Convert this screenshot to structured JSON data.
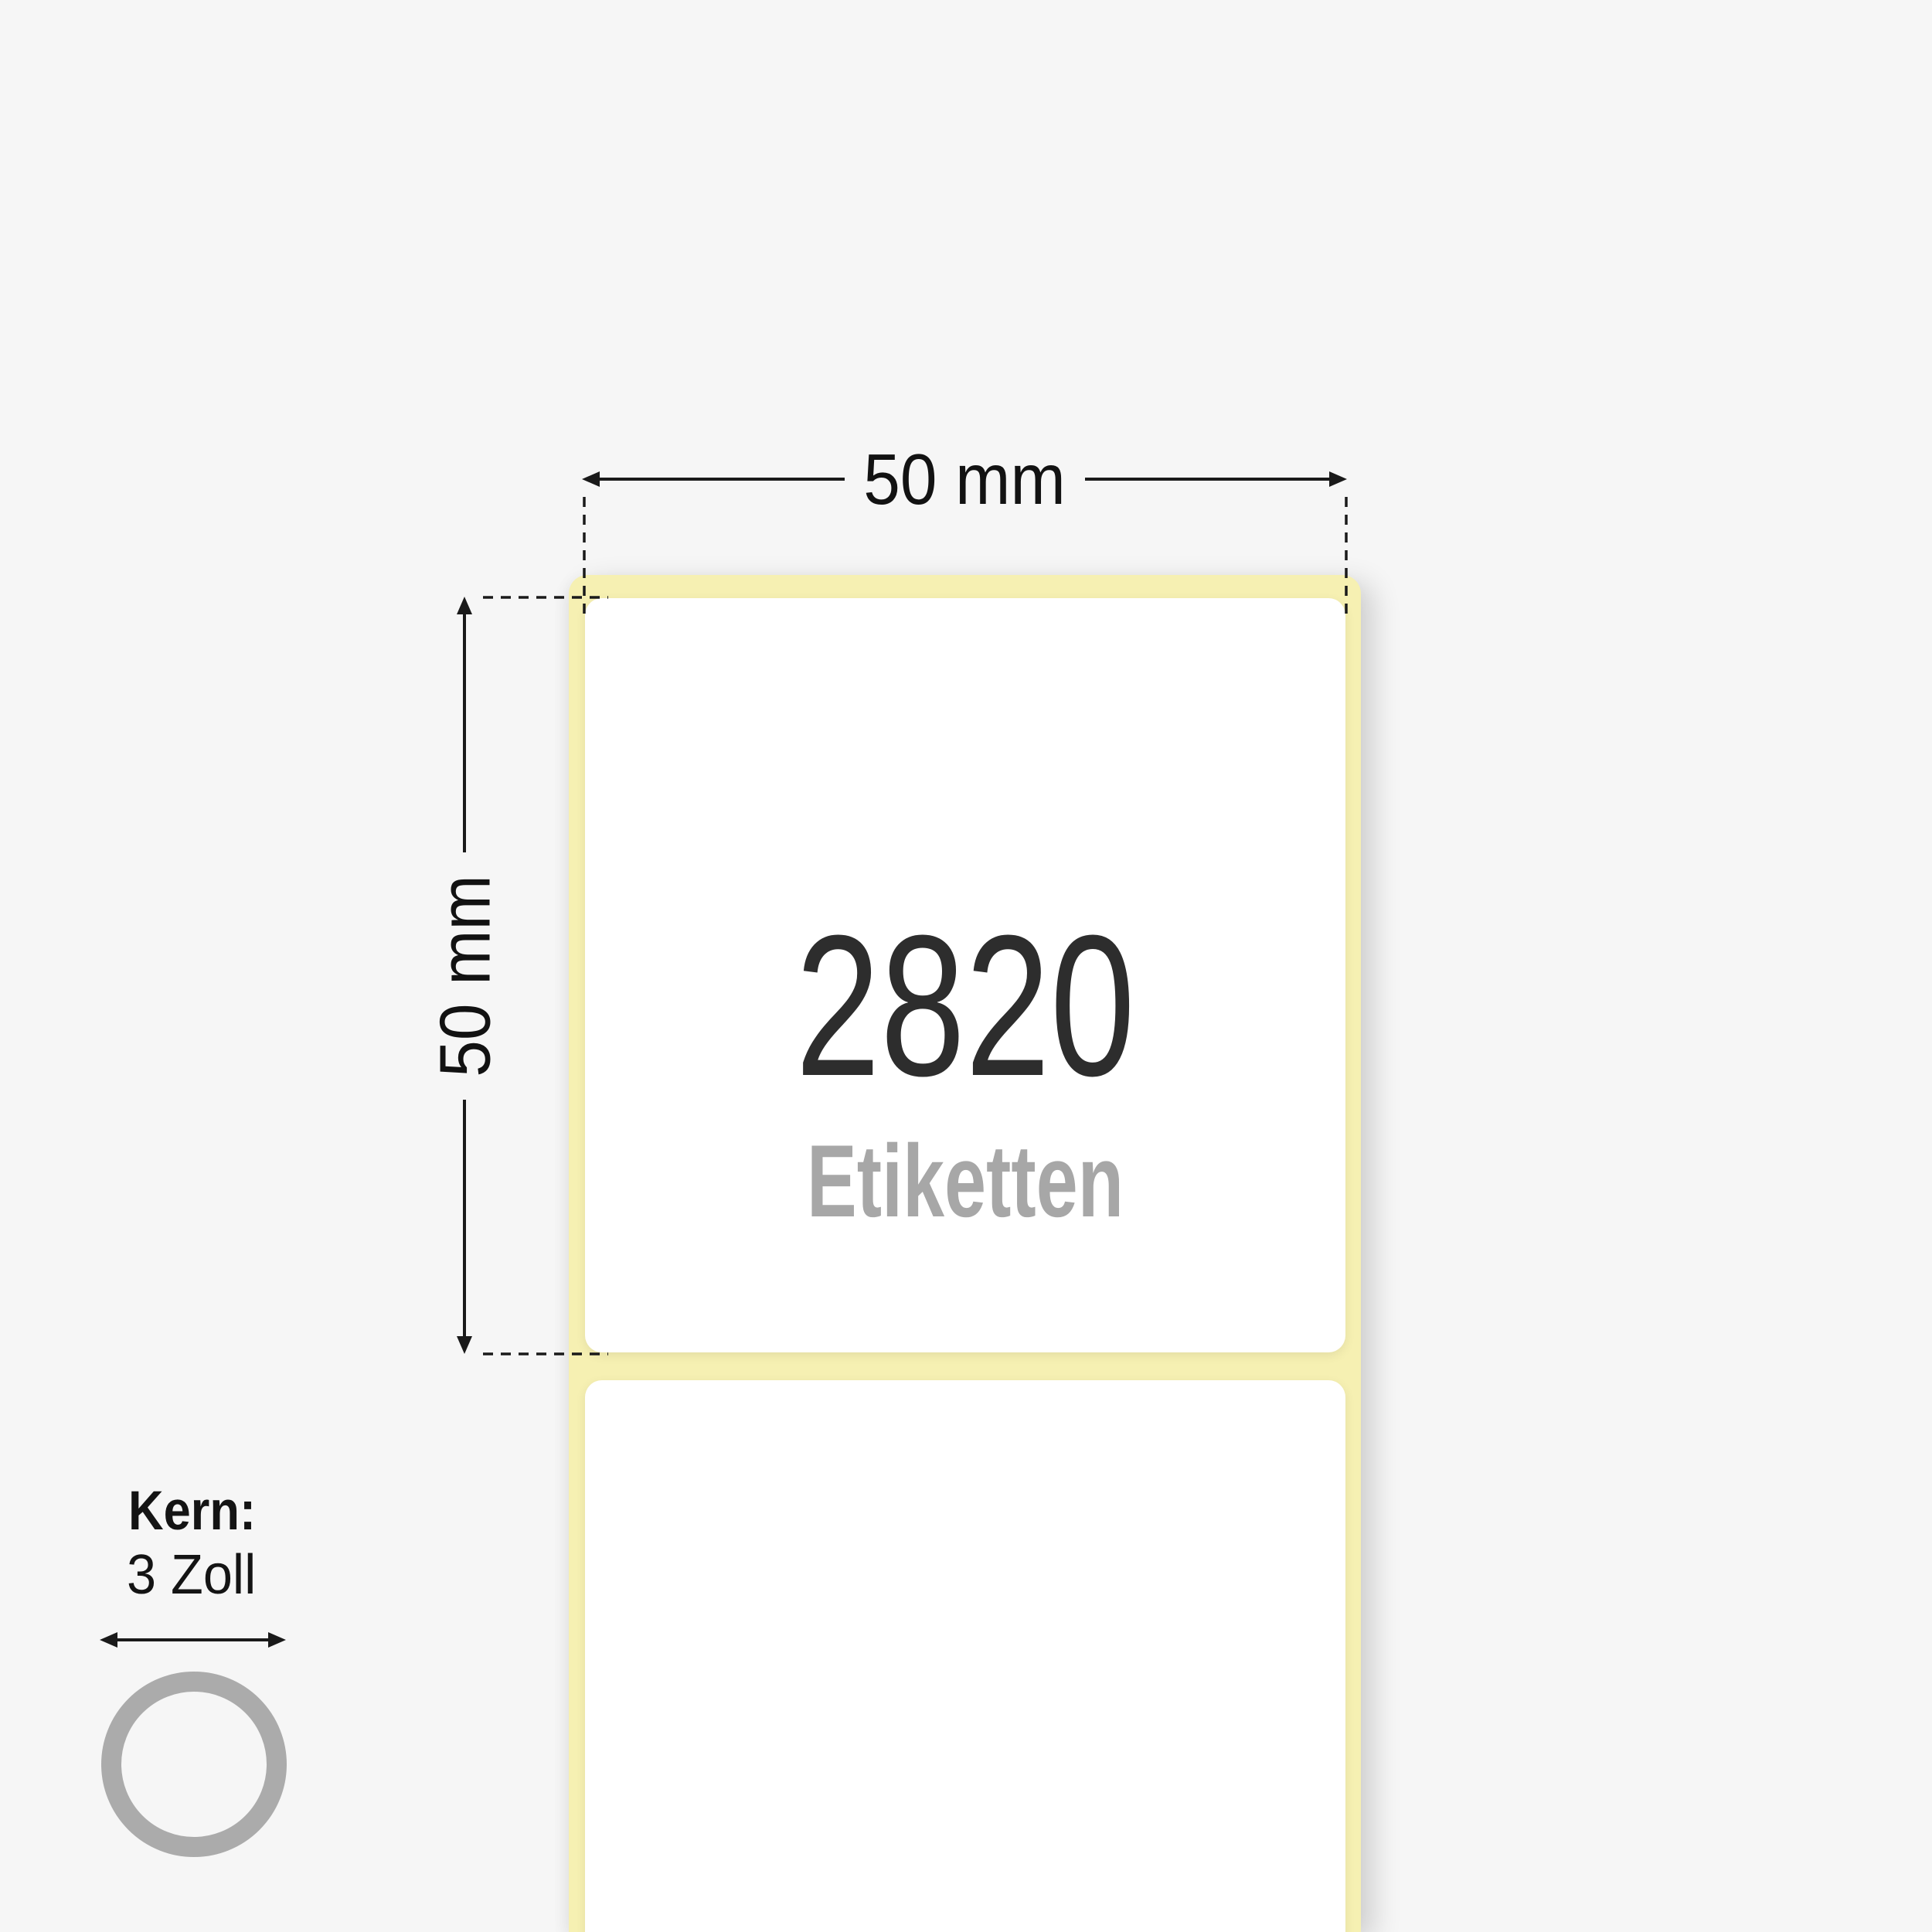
{
  "illustration": {
    "background_color": "#f6f6f6",
    "ink_color": "#1a1a1a"
  },
  "dimensions": {
    "width": {
      "label": "50 mm"
    },
    "height": {
      "label": "50 mm"
    }
  },
  "roll": {
    "liner_color": "#f6f0b2",
    "label_color": "#ffffff",
    "labels_count": "2820",
    "labels_unit": "Etiketten",
    "count_color": "#2d2d2d",
    "unit_color": "#a7a7a7"
  },
  "core": {
    "label": "Kern:",
    "value": "3 Zoll",
    "ring_color": "#ababab"
  }
}
